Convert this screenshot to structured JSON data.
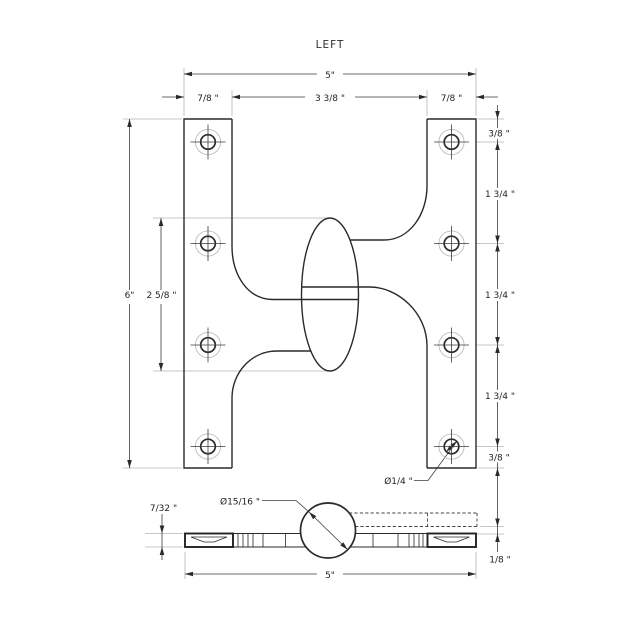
{
  "title": "LEFT",
  "colors": {
    "line": "#2a2a2a",
    "extension": "#b4b4b4",
    "text": "#1f1f1f",
    "background": "#ffffff"
  },
  "top_dimensions": {
    "overall_width": "5\"",
    "left_leaf_width": "7/8 \"",
    "center_span": "3 3/8 \"",
    "right_leaf_width": "7/8 \""
  },
  "left_dimensions": {
    "overall_height": "6\"",
    "knuckle_length": "2 5/8 \""
  },
  "right_dimensions": {
    "top_edge_to_hole": "3/8 \"",
    "hole_spacing_1": "1 3/4 \"",
    "hole_spacing_2": "1 3/4 \"",
    "hole_spacing_3": "1 3/4 \"",
    "hole_to_bottom_edge": "3/8 \"",
    "leaf_offset": "1/8 \""
  },
  "callouts": {
    "screw_hole_diameter": "Ø1/4 \"",
    "knuckle_diameter": "Ø15/16 \""
  },
  "bottom_dimensions": {
    "leaf_thickness": "7/32 \"",
    "overall_width": "5\""
  }
}
